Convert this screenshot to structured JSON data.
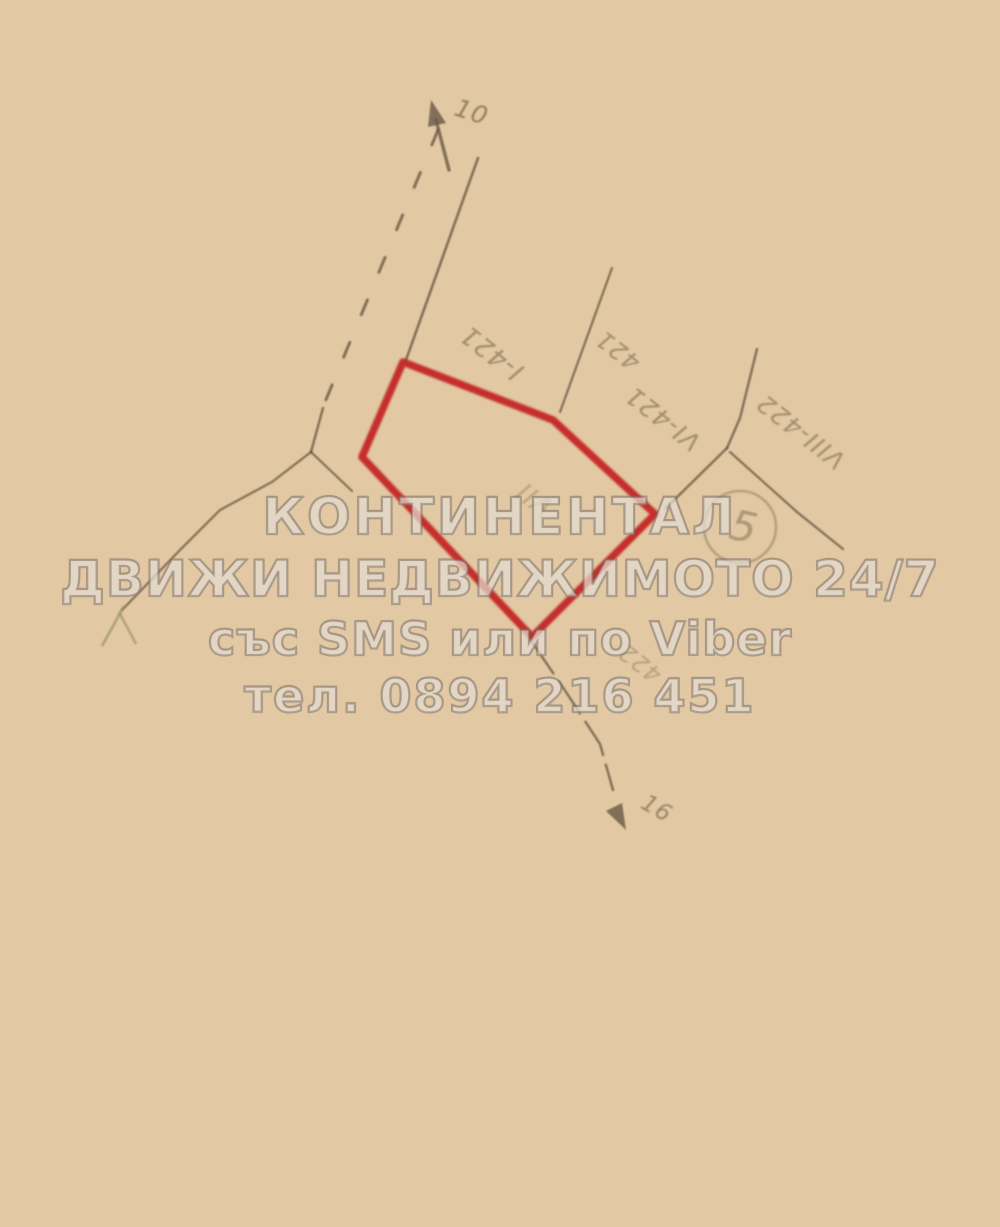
{
  "watermark": {
    "line1": "КОНТИНЕНТАЛ",
    "line2": "ДВИЖИ НЕДВИЖИМОТО 24/7",
    "line3": "със SMS или по Viber",
    "line4": "тел. 0894 216 451"
  },
  "plan": {
    "road_label_top": "10",
    "road_label_bottom": "16",
    "circled_number": "5",
    "parcels": {
      "left": "I-421",
      "top_right": "421",
      "mid_right": "VI-421",
      "far_right": "VIII-422",
      "highlighted": "VII",
      "below_highlight": "422"
    },
    "colors": {
      "highlight_outline": "#c32121",
      "ink": "#6a5a44",
      "paper": "#e6cca7",
      "label_ink": "#7c6a4f"
    }
  }
}
